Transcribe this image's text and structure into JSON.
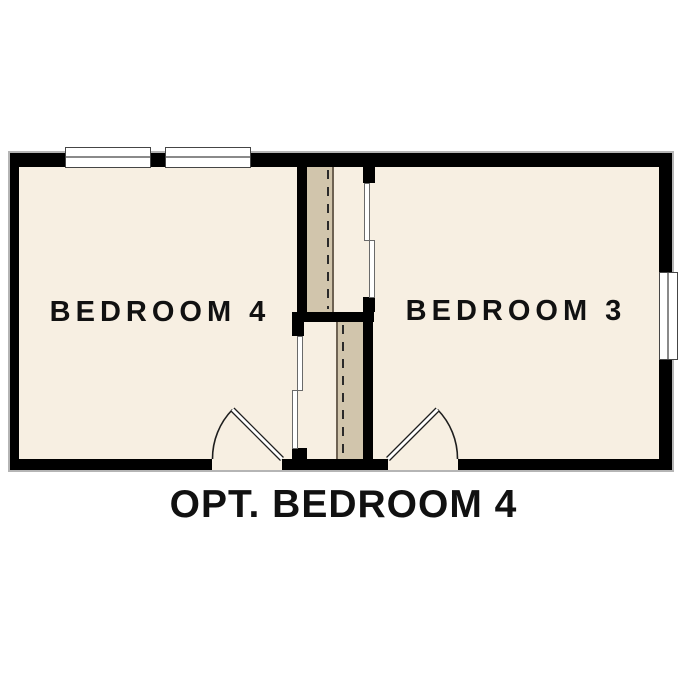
{
  "plan": {
    "caption": "OPT. BEDROOM 4",
    "rooms": [
      {
        "name": "BEDROOM 4"
      },
      {
        "name": "BEDROOM 3"
      }
    ],
    "features": {
      "windows": 3,
      "swing_doors": 2,
      "bypass_closet_doors": 2,
      "closets": 2
    },
    "colors": {
      "background": "#ffffff",
      "floor": "#f7efe2",
      "shelf": "#d1c5ac",
      "wall": "#000000",
      "text": "#111111"
    }
  }
}
